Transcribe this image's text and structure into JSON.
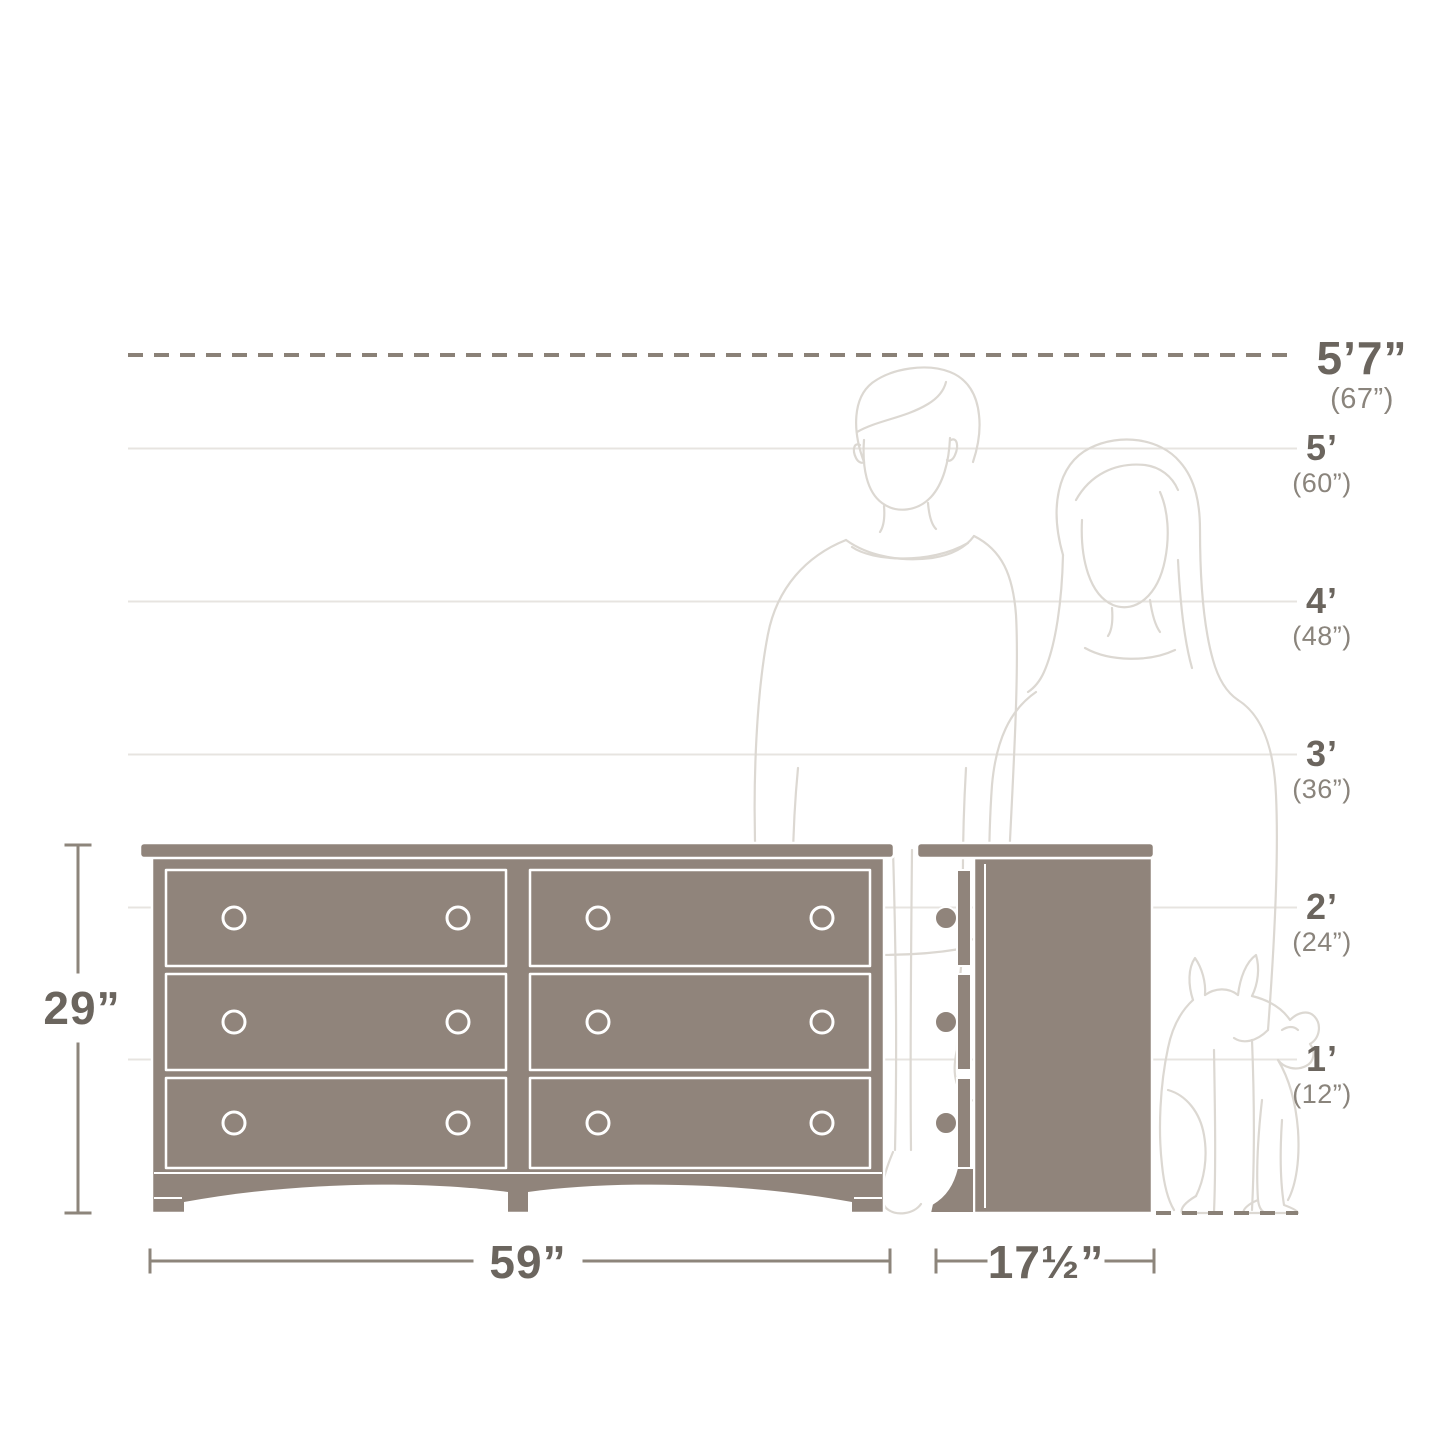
{
  "diagram_title": "Dresser size guide with human and dog scale reference",
  "colors": {
    "taupe": "#90847b",
    "gridline": "#e7e4e0",
    "dash": "#8a8177",
    "dim": "#8d857b",
    "figure": "#dcd8d2",
    "text_primary": "#6b655e",
    "text_secondary": "#8a847c"
  },
  "height_scale": {
    "marks": [
      {
        "id": "5ft7",
        "primary": "5’7”",
        "secondary": "(67”)"
      },
      {
        "id": "5ft",
        "primary": "5’",
        "secondary": "(60”)"
      },
      {
        "id": "4ft",
        "primary": "4’",
        "secondary": "(48”)"
      },
      {
        "id": "3ft",
        "primary": "3’",
        "secondary": "(36”)"
      },
      {
        "id": "2ft",
        "primary": "2’",
        "secondary": "(24”)"
      },
      {
        "id": "1ft",
        "primary": "1’",
        "secondary": "(12”)"
      }
    ]
  },
  "dimensions": {
    "height": "29”",
    "width": "59”",
    "depth": "17½”"
  },
  "figures": {
    "left_person": "man-silhouette",
    "right_person": "woman-silhouette",
    "animal": "dog-silhouette"
  },
  "furniture": {
    "front_view": "6-drawer dresser, front elevation",
    "side_view": "dresser side elevation",
    "drawer_rows": 3,
    "drawer_columns": 2
  }
}
